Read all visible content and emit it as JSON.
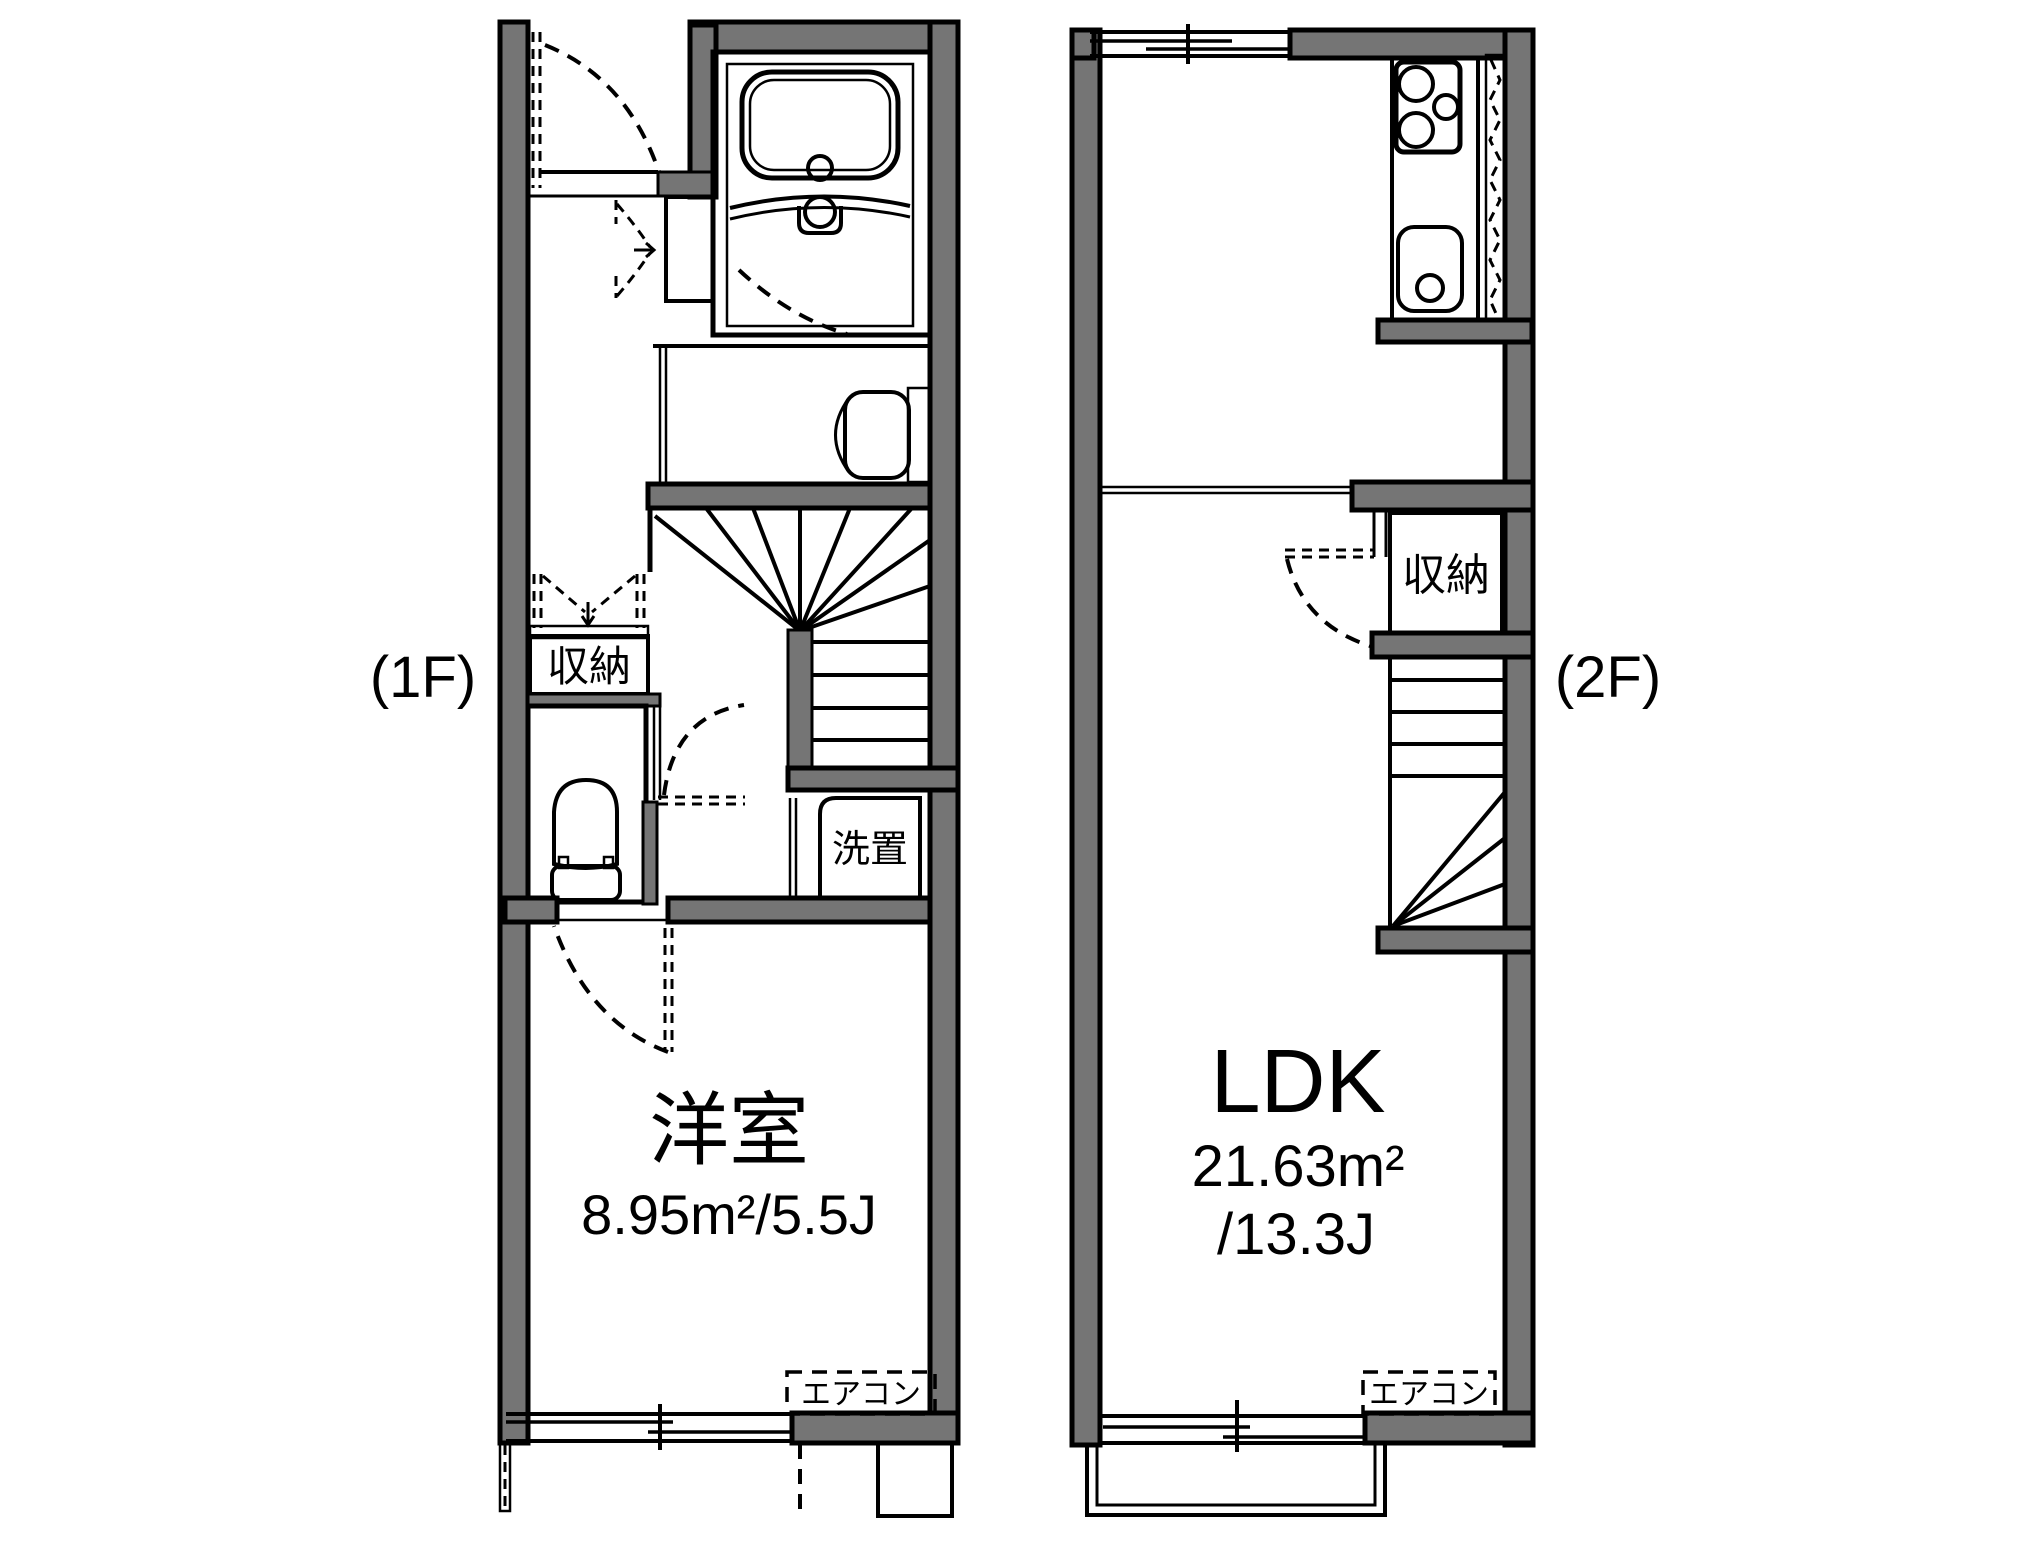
{
  "floorplan": {
    "floor1": {
      "floor_label": "(1F)",
      "room_label": "洋室",
      "room_area": "8.95m²/5.5J",
      "storage_label": "収納",
      "laundry_label": "洗置",
      "aircon_label": "エアコン"
    },
    "floor2": {
      "floor_label": "(2F)",
      "room_label": "LDK",
      "room_area_m2": "21.63m²",
      "room_area_j": "/13.3J",
      "storage_label": "収納",
      "aircon_label": "エアコン"
    },
    "colors": {
      "wall_gray": "#757575",
      "water_fixture_blue": "#dce7f7",
      "storage_beige": "#fbf0d8",
      "line_black": "#000000",
      "background": "#ffffff"
    }
  }
}
